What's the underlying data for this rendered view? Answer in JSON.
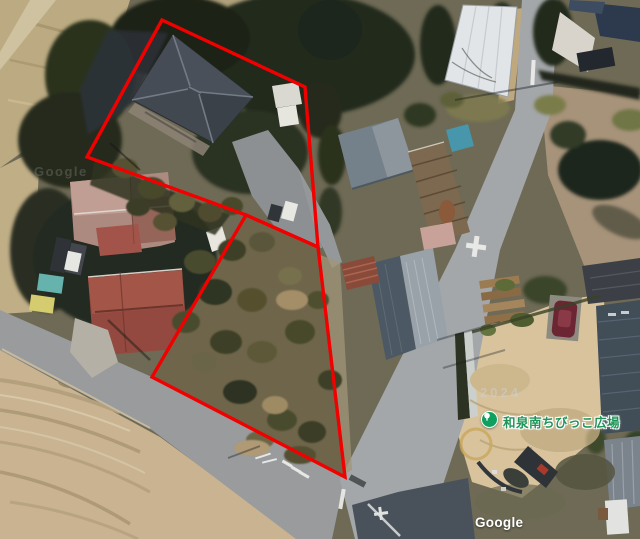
{
  "poi": {
    "label": "和泉南ちびっこ広場",
    "type": "park-marker",
    "marker_color": "#0fa05f",
    "label_color": "#1f9458"
  },
  "attribution": {
    "logo": "Google"
  },
  "watermarks": {
    "tile": "Google",
    "year": "2024"
  },
  "overlay": {
    "color": "#f10000",
    "stroke_width": 3.4,
    "parcel1_points": "162,20 305,87 318,247 246,215 87,157",
    "parcel2_points": "246,215 318,247 345,477 152,377"
  }
}
